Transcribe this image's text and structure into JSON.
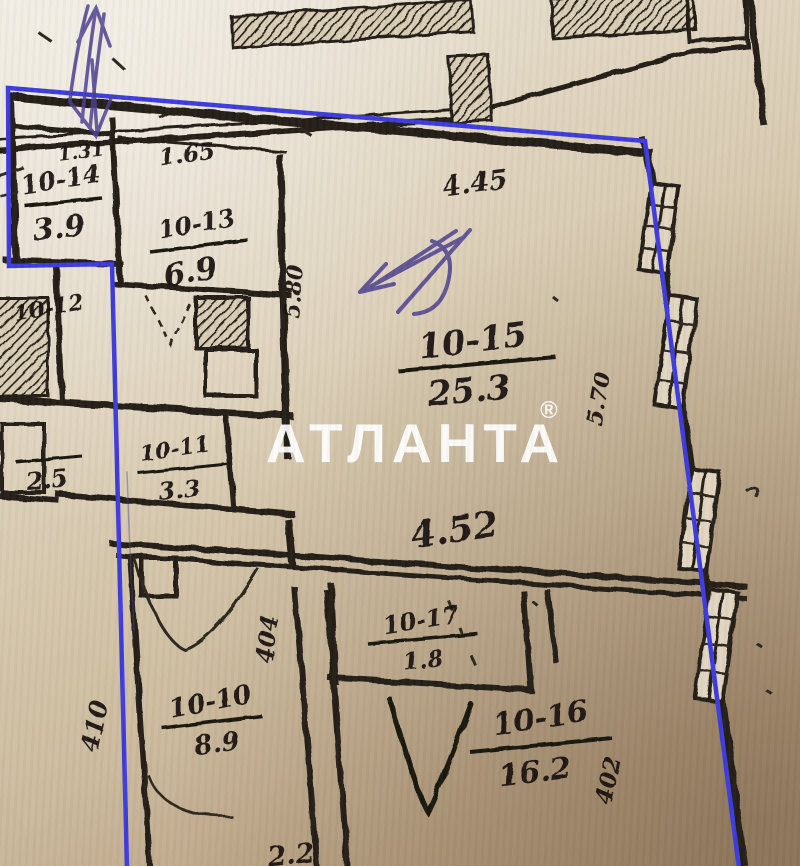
{
  "photo": {
    "watermark_text": "АТЛАНТА",
    "watermark_mark": "®"
  },
  "plan": {
    "outline_color": "#3b3ade",
    "pen_ink_color": "#4a3d8f",
    "rooms": [
      {
        "id": "10-14",
        "area": "3.9"
      },
      {
        "id": "10-13",
        "area": "6.9"
      },
      {
        "id": "10-12",
        "area": "2.5"
      },
      {
        "id": "10-11",
        "area": "3.3"
      },
      {
        "id": "10-15",
        "area": "25.3"
      },
      {
        "id": "10-17",
        "area": "1.8"
      },
      {
        "id": "10-10",
        "area": "8.9"
      },
      {
        "id": "10-16",
        "area": "16.2"
      }
    ],
    "dimensions": {
      "entry_top": "1.31",
      "hall_top": "1.65",
      "room15_top": "4.45",
      "room15_bottom": "4.52",
      "room15_left": "5.80",
      "room15_right": "5.70",
      "room10_left": "410",
      "room10_right": "404",
      "room16_right": "402",
      "bottom_edge": "2.2"
    }
  }
}
